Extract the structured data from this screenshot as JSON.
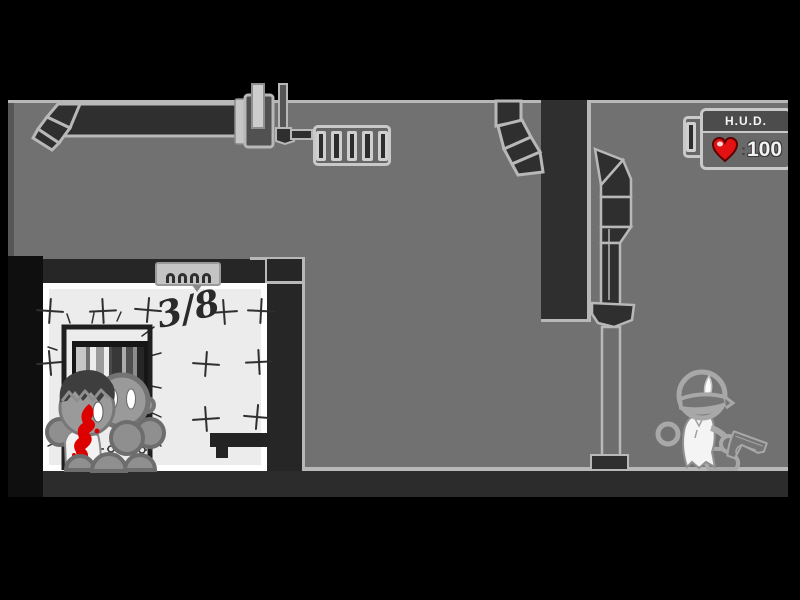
{
  "hud": {
    "title": "H.U.D.",
    "separator": ":",
    "health": "100",
    "health_icon": "heart-icon",
    "heart_color": "#e31111"
  },
  "room": {
    "counter": "3/8"
  },
  "colors": {
    "background": "#717171",
    "dark_wall": "#2f2f2f",
    "outline_light": "#b8b8b8",
    "room_fill": "#ececec",
    "room_wall": "#ffffff",
    "blood": "#dd0000",
    "hud_header": "#4c4c4c",
    "hud_border": "#c9c9c9"
  }
}
